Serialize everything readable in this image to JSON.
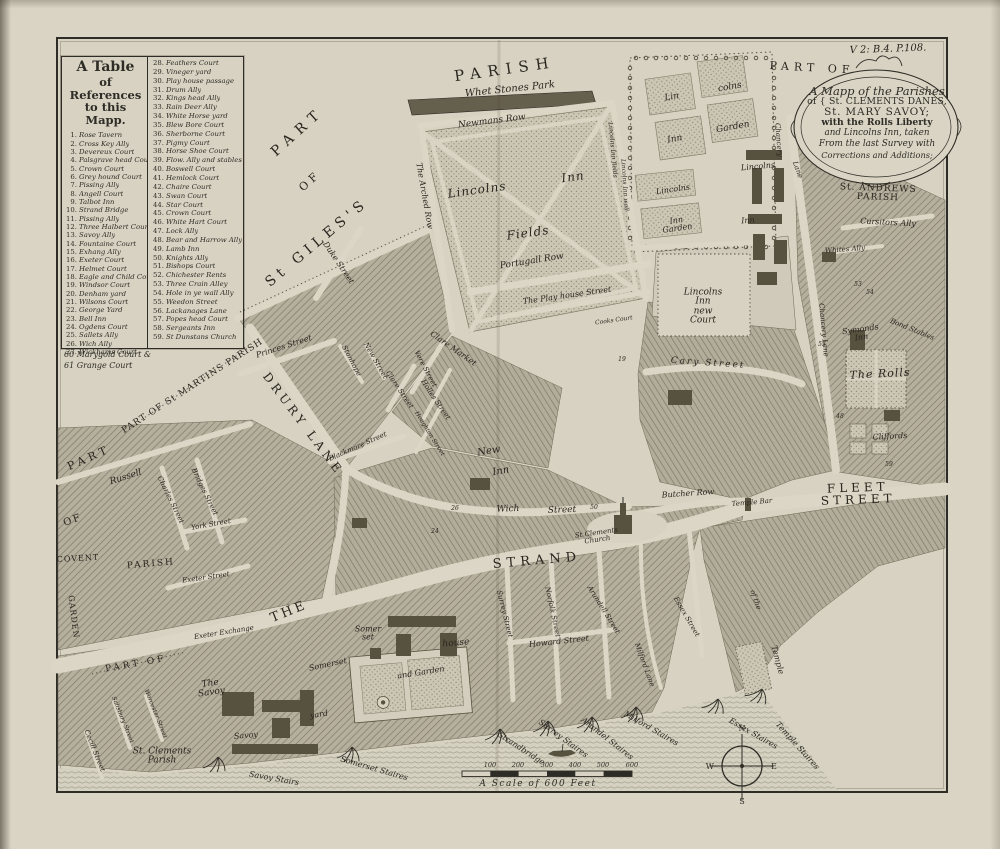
{
  "reference_table": {
    "title_lines": [
      "A Table",
      "of References",
      "to this Mapp."
    ],
    "col1": [
      {
        "n": "1",
        "label": "Rose Tavern"
      },
      {
        "n": "2",
        "label": "Cross Key Ally"
      },
      {
        "n": "3",
        "label": "Devereux Court"
      },
      {
        "n": "4",
        "label": "Palsgrave head Court"
      },
      {
        "n": "5",
        "label": "Crown Court"
      },
      {
        "n": "6",
        "label": "Grey hound Court"
      },
      {
        "n": "7",
        "label": "Pissing Ally"
      },
      {
        "n": "8",
        "label": "Angell Court"
      },
      {
        "n": "9",
        "label": "Talbot Inn"
      },
      {
        "n": "10",
        "label": "Strand Bridge"
      },
      {
        "n": "11",
        "label": "Pissing Ally"
      },
      {
        "n": "12",
        "label": "Three Halbert Court"
      },
      {
        "n": "13",
        "label": "Savoy Ally"
      },
      {
        "n": "14",
        "label": "Fountaine Court"
      },
      {
        "n": "15",
        "label": "Exhang Ally"
      },
      {
        "n": "16",
        "label": "Exeter Court"
      },
      {
        "n": "17",
        "label": "Helmet Court"
      },
      {
        "n": "18",
        "label": "Eagle and Child Court"
      },
      {
        "n": "19",
        "label": "Windsor Court"
      },
      {
        "n": "20",
        "label": "Denham yard"
      },
      {
        "n": "21",
        "label": "Wilsons Court"
      },
      {
        "n": "22",
        "label": "George Yard"
      },
      {
        "n": "23",
        "label": "Bell Inn"
      },
      {
        "n": "24",
        "label": "Ogdens Court"
      },
      {
        "n": "25",
        "label": "Sallets Ally"
      },
      {
        "n": "26",
        "label": "Wich Ally"
      },
      {
        "n": "27",
        "label": "Wickhams Court"
      }
    ],
    "col2": [
      {
        "n": "28",
        "label": "Feathers Court"
      },
      {
        "n": "29",
        "label": "Vineger yard"
      },
      {
        "n": "30",
        "label": "Play house passage"
      },
      {
        "n": "31",
        "label": "Drum Ally"
      },
      {
        "n": "32",
        "label": "Kings head Ally"
      },
      {
        "n": "33",
        "label": "Rain Deer Ally"
      },
      {
        "n": "34",
        "label": "White Horse yard"
      },
      {
        "n": "35",
        "label": "Blew Bore Court"
      },
      {
        "n": "36",
        "label": "Sherborne Court"
      },
      {
        "n": "37",
        "label": "Pigmy Court"
      },
      {
        "n": "38",
        "label": "Horse Shoe Court"
      },
      {
        "n": "39",
        "label": "Flow. Ally and stables"
      },
      {
        "n": "40",
        "label": "Boswell Court"
      },
      {
        "n": "41",
        "label": "Hemlock Court"
      },
      {
        "n": "42",
        "label": "Chaire Court"
      },
      {
        "n": "43",
        "label": "Swan Court"
      },
      {
        "n": "44",
        "label": "Star Court"
      },
      {
        "n": "45",
        "label": "Crown Court"
      },
      {
        "n": "46",
        "label": "White Hart Court"
      },
      {
        "n": "47",
        "label": "Lock Ally"
      },
      {
        "n": "48",
        "label": "Bear and Harrow Ally"
      },
      {
        "n": "49",
        "label": "Lamb Inn"
      },
      {
        "n": "50",
        "label": "Knights Ally"
      },
      {
        "n": "51",
        "label": "Bishops Court"
      },
      {
        "n": "52",
        "label": "Chichester Rents"
      },
      {
        "n": "53",
        "label": "Three Crain Alley"
      },
      {
        "n": "54",
        "label": "Hole in ye wall Ally"
      },
      {
        "n": "55",
        "label": "Weedon Street"
      },
      {
        "n": "56",
        "label": "Lackanages Lane"
      },
      {
        "n": "57",
        "label": "Popes head Court"
      },
      {
        "n": "58",
        "label": "Sergeants Inn"
      },
      {
        "n": "59",
        "label": "St Dunstans Church"
      }
    ],
    "footnote_lines": [
      "60 Marygold Court &",
      "61 Grange Court"
    ]
  },
  "cartouche": {
    "lines": [
      "A Mapp of the Parishes",
      "of { St. CLEMENTS DANES,",
      "St. MARY SAVOY;",
      "with the Rolls Liberty",
      "and Lincolns Inn, taken",
      "From the last Survey with",
      "Corrections and Additions;"
    ]
  },
  "scale_bar": {
    "ticks": [
      "100",
      "200",
      "300",
      "400",
      "500",
      "600"
    ],
    "caption": "A Scale of 600 Feet"
  },
  "compass": {
    "n": "N",
    "e": "E",
    "s": "S",
    "w": "W"
  },
  "colors": {
    "paper": "#d9d4c3",
    "plate": "#d7d2c1",
    "ink": "#2e2c26",
    "block": "#b5af9e",
    "hatch_line": "#837d6a",
    "stipple_dot": "#8d8776",
    "river_line": "#a29d8c",
    "building": "#57523f"
  },
  "map_labels": [
    {
      "t": "PARISH",
      "x": 505,
      "y": 70,
      "r": -8,
      "s": 15,
      "sp": 7
    },
    {
      "t": "Whet Stones Park",
      "x": 510,
      "y": 90,
      "r": -6,
      "s": 10,
      "it": 1
    },
    {
      "t": "Newmans Row",
      "x": 492,
      "y": 122,
      "r": -7,
      "s": 9,
      "it": 1
    },
    {
      "t": "PART",
      "x": 298,
      "y": 132,
      "r": -42,
      "s": 14,
      "sp": 7
    },
    {
      "t": "OF",
      "x": 310,
      "y": 181,
      "r": -42,
      "s": 11,
      "sp": 4
    },
    {
      "t": "St GILES'S",
      "x": 317,
      "y": 243,
      "r": -40,
      "s": 14,
      "sp": 5
    },
    {
      "t": "The Arched Row",
      "x": 424,
      "y": 196,
      "r": 80,
      "s": 8,
      "it": 1
    },
    {
      "t": "Lincolns",
      "x": 477,
      "y": 190,
      "r": -8,
      "s": 12,
      "it": 1,
      "sp": 1
    },
    {
      "t": "Inn",
      "x": 573,
      "y": 177,
      "r": -8,
      "s": 12,
      "it": 1,
      "sp": 1
    },
    {
      "t": "Fields",
      "x": 528,
      "y": 233,
      "r": -8,
      "s": 12,
      "it": 1,
      "sp": 1
    },
    {
      "t": "Portugall Row",
      "x": 532,
      "y": 262,
      "r": -9,
      "s": 9,
      "it": 1
    },
    {
      "t": "The Play house Street",
      "x": 567,
      "y": 296,
      "r": -8,
      "s": 8,
      "it": 1
    },
    {
      "t": "Cooks Court",
      "x": 614,
      "y": 321,
      "r": -8,
      "s": 6,
      "it": 1
    },
    {
      "t": "Lincolns\nInn\nnew\nCourt",
      "x": 703,
      "y": 307,
      "r": 0,
      "s": 9,
      "it": 1
    },
    {
      "t": "Cary Street",
      "x": 708,
      "y": 364,
      "r": 4,
      "s": 9,
      "it": 1,
      "sp": 2
    },
    {
      "t": "Lin",
      "x": 672,
      "y": 98,
      "r": -10,
      "s": 9,
      "it": 1
    },
    {
      "t": "colns",
      "x": 730,
      "y": 88,
      "r": -10,
      "s": 9,
      "it": 1
    },
    {
      "t": "Inn",
      "x": 675,
      "y": 140,
      "r": -10,
      "s": 9,
      "it": 1
    },
    {
      "t": "Garden",
      "x": 733,
      "y": 128,
      "r": -10,
      "s": 9,
      "it": 1
    },
    {
      "t": "Lincolns",
      "x": 673,
      "y": 190,
      "r": -8,
      "s": 8,
      "it": 1
    },
    {
      "t": "Inn\nGarden",
      "x": 677,
      "y": 225,
      "r": -8,
      "s": 8,
      "it": 1
    },
    {
      "t": "Lincolns",
      "x": 758,
      "y": 167,
      "r": -5,
      "s": 8,
      "it": 1
    },
    {
      "t": "Inn",
      "x": 748,
      "y": 221,
      "r": -5,
      "s": 8,
      "it": 1
    },
    {
      "t": "Lincolns Inn wall",
      "x": 624,
      "y": 185,
      "r": 86,
      "s": 6,
      "it": 1
    },
    {
      "t": "Lincolns Inn fields",
      "x": 612,
      "y": 150,
      "r": 85,
      "s": 6,
      "it": 1
    },
    {
      "t": "PART OF",
      "x": 812,
      "y": 68,
      "r": 3,
      "s": 11,
      "sp": 5
    },
    {
      "t": "V 2: B.4. P.108.",
      "x": 888,
      "y": 50,
      "r": -2,
      "s": 10,
      "it": 1
    },
    {
      "t": "St. ANDREWS   PARISH",
      "x": 878,
      "y": 194,
      "r": 2,
      "s": 9,
      "sp": 1
    },
    {
      "t": "Cursitors Ally",
      "x": 888,
      "y": 223,
      "r": 3,
      "s": 8,
      "it": 1
    },
    {
      "t": "Whites Ally",
      "x": 845,
      "y": 250,
      "r": -4,
      "s": 7,
      "it": 1
    },
    {
      "t": "Symonds\nInn",
      "x": 861,
      "y": 334,
      "r": -8,
      "s": 8,
      "it": 1
    },
    {
      "t": "Bond Stables",
      "x": 912,
      "y": 330,
      "r": 22,
      "s": 7,
      "it": 1
    },
    {
      "t": "The Rolls",
      "x": 880,
      "y": 374,
      "r": -3,
      "s": 11,
      "it": 1,
      "sp": 1
    },
    {
      "t": "Cliffords",
      "x": 890,
      "y": 437,
      "r": -3,
      "s": 8,
      "it": 1
    },
    {
      "t": "Chancery",
      "x": 778,
      "y": 140,
      "r": 86,
      "s": 7,
      "it": 1
    },
    {
      "t": "Lane",
      "x": 797,
      "y": 170,
      "r": 70,
      "s": 7,
      "it": 1
    },
    {
      "t": "Chancery Lane",
      "x": 823,
      "y": 330,
      "r": 85,
      "s": 7,
      "it": 1
    },
    {
      "t": "DRURY LANE",
      "x": 303,
      "y": 424,
      "r": 53,
      "s": 12,
      "sp": 4
    },
    {
      "t": "Princes Street",
      "x": 284,
      "y": 347,
      "r": -18,
      "s": 8,
      "it": 1
    },
    {
      "t": "Duke Street",
      "x": 338,
      "y": 263,
      "r": 56,
      "s": 8,
      "it": 1
    },
    {
      "t": "Stanhope",
      "x": 351,
      "y": 361,
      "r": 62,
      "s": 7,
      "it": 1
    },
    {
      "t": "New Street",
      "x": 375,
      "y": 361,
      "r": 60,
      "s": 7,
      "it": 1
    },
    {
      "t": "Vere Street",
      "x": 425,
      "y": 369,
      "r": 62,
      "s": 7,
      "it": 1
    },
    {
      "t": "Clare Street",
      "x": 399,
      "y": 390,
      "r": 56,
      "s": 7,
      "it": 1
    },
    {
      "t": "Clare Market",
      "x": 453,
      "y": 349,
      "r": 35,
      "s": 8,
      "it": 1
    },
    {
      "t": "Holles Street",
      "x": 435,
      "y": 400,
      "r": 56,
      "s": 7,
      "it": 1
    },
    {
      "t": "Houghton Street",
      "x": 429,
      "y": 434,
      "r": 58,
      "s": 6,
      "it": 1
    },
    {
      "t": "Blackmore Street",
      "x": 358,
      "y": 447,
      "r": -24,
      "s": 7,
      "it": 1
    },
    {
      "t": "New",
      "x": 489,
      "y": 452,
      "r": -10,
      "s": 10,
      "it": 1
    },
    {
      "t": "Inn",
      "x": 501,
      "y": 472,
      "r": -10,
      "s": 10,
      "it": 1
    },
    {
      "t": "Wich",
      "x": 508,
      "y": 510,
      "r": -2,
      "s": 9,
      "it": 1
    },
    {
      "t": "Street",
      "x": 562,
      "y": 511,
      "r": -2,
      "s": 9,
      "it": 1
    },
    {
      "t": "Butcher Row",
      "x": 688,
      "y": 494,
      "r": -4,
      "s": 8,
      "it": 1
    },
    {
      "t": "Temple Bar",
      "x": 752,
      "y": 503,
      "r": -5,
      "s": 7,
      "it": 1
    },
    {
      "t": "FLEET STREET",
      "x": 858,
      "y": 494,
      "r": -2,
      "s": 12,
      "sp": 4
    },
    {
      "t": "THE",
      "x": 289,
      "y": 612,
      "r": -22,
      "s": 13,
      "sp": 3
    },
    {
      "t": "STRAND",
      "x": 537,
      "y": 561,
      "r": -5,
      "s": 13,
      "sp": 5
    },
    {
      "t": "St Clements\nChurch",
      "x": 597,
      "y": 537,
      "r": -8,
      "s": 7,
      "it": 1
    },
    {
      "t": "Exeter Exchange",
      "x": 224,
      "y": 633,
      "r": -9,
      "s": 7,
      "it": 1
    },
    {
      "t": "Exeter Street",
      "x": 206,
      "y": 578,
      "r": -8,
      "s": 7,
      "it": 1
    },
    {
      "t": "Russell",
      "x": 126,
      "y": 478,
      "r": -18,
      "s": 9,
      "it": 1
    },
    {
      "t": "PART",
      "x": 89,
      "y": 458,
      "r": -24,
      "s": 11,
      "sp": 4
    },
    {
      "t": "OF",
      "x": 73,
      "y": 521,
      "r": -20,
      "s": 10,
      "sp": 2
    },
    {
      "t": "COVENT",
      "x": 78,
      "y": 559,
      "r": -3,
      "s": 8,
      "sp": 1
    },
    {
      "t": "GARDEN",
      "x": 73,
      "y": 617,
      "r": 83,
      "s": 8,
      "sp": 1
    },
    {
      "t": "PARISH",
      "x": 151,
      "y": 565,
      "r": -5,
      "s": 9,
      "sp": 2
    },
    {
      "t": "Charles Street",
      "x": 170,
      "y": 500,
      "r": 64,
      "s": 7,
      "it": 1
    },
    {
      "t": "Bridges Street",
      "x": 204,
      "y": 492,
      "r": 64,
      "s": 7,
      "it": 1
    },
    {
      "t": "York Street",
      "x": 211,
      "y": 525,
      "r": -10,
      "s": 7,
      "it": 1
    },
    {
      "t": "PART OF St MARTINS PARISH",
      "x": 193,
      "y": 387,
      "r": -33,
      "s": 9,
      "sp": 1
    },
    {
      "t": "PART OF",
      "x": 136,
      "y": 665,
      "r": -10,
      "s": 9,
      "sp": 3
    },
    {
      "t": "St. Clements\nParish",
      "x": 162,
      "y": 757,
      "r": 0,
      "s": 9,
      "it": 1
    },
    {
      "t": "The\nSavoy",
      "x": 211,
      "y": 689,
      "r": -8,
      "s": 9,
      "it": 1
    },
    {
      "t": "Savoy",
      "x": 246,
      "y": 736,
      "r": -5,
      "s": 8,
      "it": 1
    },
    {
      "t": "Cecill Street",
      "x": 94,
      "y": 751,
      "r": 68,
      "s": 7,
      "it": 1
    },
    {
      "t": "Salisbury Street",
      "x": 122,
      "y": 720,
      "r": 68,
      "s": 6,
      "it": 1
    },
    {
      "t": "Worcester Street",
      "x": 155,
      "y": 714,
      "r": 68,
      "s": 6,
      "it": 1
    },
    {
      "t": "Somerset",
      "x": 328,
      "y": 665,
      "r": -12,
      "s": 8,
      "it": 1
    },
    {
      "t": "yard",
      "x": 319,
      "y": 715,
      "r": -8,
      "s": 8,
      "it": 1
    },
    {
      "t": "Somer\nset",
      "x": 368,
      "y": 634,
      "r": 0,
      "s": 8,
      "it": 1
    },
    {
      "t": "house",
      "x": 456,
      "y": 644,
      "r": -5,
      "s": 9,
      "it": 1
    },
    {
      "t": "and Garden",
      "x": 421,
      "y": 673,
      "r": -9,
      "s": 8,
      "it": 1
    },
    {
      "t": "Savoy Stairs",
      "x": 274,
      "y": 779,
      "r": 10,
      "s": 8,
      "it": 1
    },
    {
      "t": "Somerset Staires",
      "x": 374,
      "y": 769,
      "r": 16,
      "s": 8,
      "it": 1
    },
    {
      "t": "Strandbridge",
      "x": 521,
      "y": 749,
      "r": 33,
      "s": 8,
      "it": 1
    },
    {
      "t": "Surrey Staires",
      "x": 563,
      "y": 739,
      "r": 36,
      "s": 8,
      "it": 1
    },
    {
      "t": "Arundel Staires",
      "x": 607,
      "y": 739,
      "r": 38,
      "s": 8,
      "it": 1
    },
    {
      "t": "Milford Staires",
      "x": 651,
      "y": 729,
      "r": 30,
      "s": 8,
      "it": 1
    },
    {
      "t": "Essex Staires",
      "x": 753,
      "y": 734,
      "r": 30,
      "s": 8,
      "it": 1
    },
    {
      "t": "Temple Staires",
      "x": 797,
      "y": 746,
      "r": 48,
      "s": 8,
      "it": 1
    },
    {
      "t": "Temple",
      "x": 777,
      "y": 660,
      "r": 75,
      "s": 8,
      "it": 1
    },
    {
      "t": "of the",
      "x": 755,
      "y": 600,
      "r": 70,
      "s": 7,
      "it": 1
    },
    {
      "t": "Surrey Street",
      "x": 504,
      "y": 614,
      "r": 76,
      "s": 7,
      "it": 1
    },
    {
      "t": "Norfolk Street",
      "x": 552,
      "y": 612,
      "r": 78,
      "s": 7,
      "it": 1
    },
    {
      "t": "Howard Street",
      "x": 559,
      "y": 642,
      "r": -6,
      "s": 8,
      "it": 1
    },
    {
      "t": "Arundell Street",
      "x": 603,
      "y": 610,
      "r": 58,
      "s": 7,
      "it": 1
    },
    {
      "t": "Milford Lane",
      "x": 644,
      "y": 665,
      "r": 70,
      "s": 7,
      "it": 1
    },
    {
      "t": "Essex Street",
      "x": 686,
      "y": 617,
      "r": 60,
      "s": 7,
      "it": 1
    },
    {
      "t": "19",
      "x": 622,
      "y": 360,
      "r": 0,
      "s": 6,
      "it": 1
    },
    {
      "t": "24",
      "x": 435,
      "y": 532,
      "r": 0,
      "s": 6,
      "it": 1
    },
    {
      "t": "26",
      "x": 455,
      "y": 509,
      "r": 0,
      "s": 6,
      "it": 1
    },
    {
      "t": "50",
      "x": 594,
      "y": 508,
      "r": 0,
      "s": 6,
      "it": 1
    },
    {
      "t": "59",
      "x": 889,
      "y": 465,
      "r": 0,
      "s": 6,
      "it": 1
    },
    {
      "t": "53",
      "x": 858,
      "y": 285,
      "r": 0,
      "s": 6,
      "it": 1
    },
    {
      "t": "54",
      "x": 870,
      "y": 293,
      "r": 0,
      "s": 6,
      "it": 1
    },
    {
      "t": "55",
      "x": 822,
      "y": 345,
      "r": 0,
      "s": 6,
      "it": 1
    },
    {
      "t": "48",
      "x": 840,
      "y": 417,
      "r": 0,
      "s": 6,
      "it": 1
    }
  ]
}
